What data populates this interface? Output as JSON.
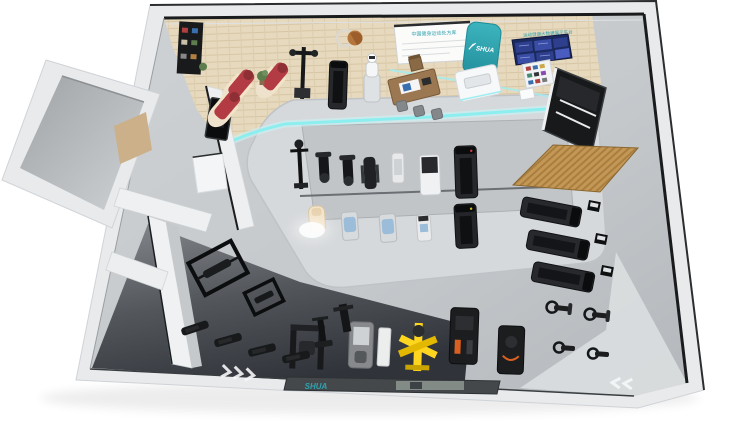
{
  "scene": {
    "description": "3D isometric floor-plan render of a SHUA fitness equipment showroom",
    "brand": "SHUA"
  },
  "signage": {
    "whiteboard_heading": "中国健身运动处方库",
    "shua_logo": "SHUA",
    "screen_wall_heading": "运动健康大数据展示平台",
    "floor_mat_brand": "SHUA"
  },
  "palette": {
    "background": "#ffffff",
    "wall": "#e8eaec",
    "wall_trim": "#1a1b1d",
    "floor_main": "#c5c9cc",
    "floor_wood": "#e6d9be",
    "floor_dark": "#33373b",
    "platform": "#d6d9db",
    "platform_inner": "#c2c5c8",
    "accent_teal": "#2fa3af",
    "led_cyan": "#8deef0",
    "screen_blue": "#2e3f8e",
    "chair_red": "#b23b44",
    "chair_cream": "#f3e3c9",
    "physio_blue": "#9bbdd9",
    "machine_yellow": "#ffd61f",
    "machine_black": "#1b1d1f",
    "canopy_wood": "#c49757"
  }
}
